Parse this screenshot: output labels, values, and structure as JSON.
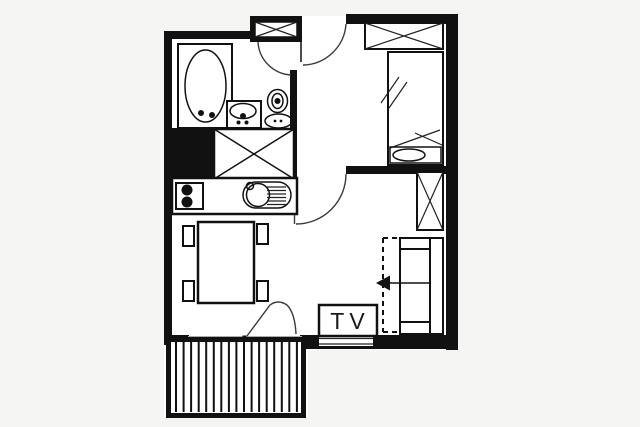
{
  "labels": {
    "tv": "TV"
  },
  "colors": {
    "wall": "#111111",
    "line": "#222222",
    "background": "#f5f5f4",
    "floor": "#ffffff"
  },
  "fixtures": [
    "bathtub",
    "vanity-sink",
    "toilet",
    "entry-closet",
    "wardrobe",
    "single-bed",
    "sofa-bed",
    "pullout-arrow",
    "dining-table",
    "chair",
    "stove",
    "kitchen-sink",
    "tv-unit",
    "balcony-decking",
    "entrance-door",
    "bathroom-door",
    "living-room-door",
    "balcony-door",
    "window"
  ]
}
